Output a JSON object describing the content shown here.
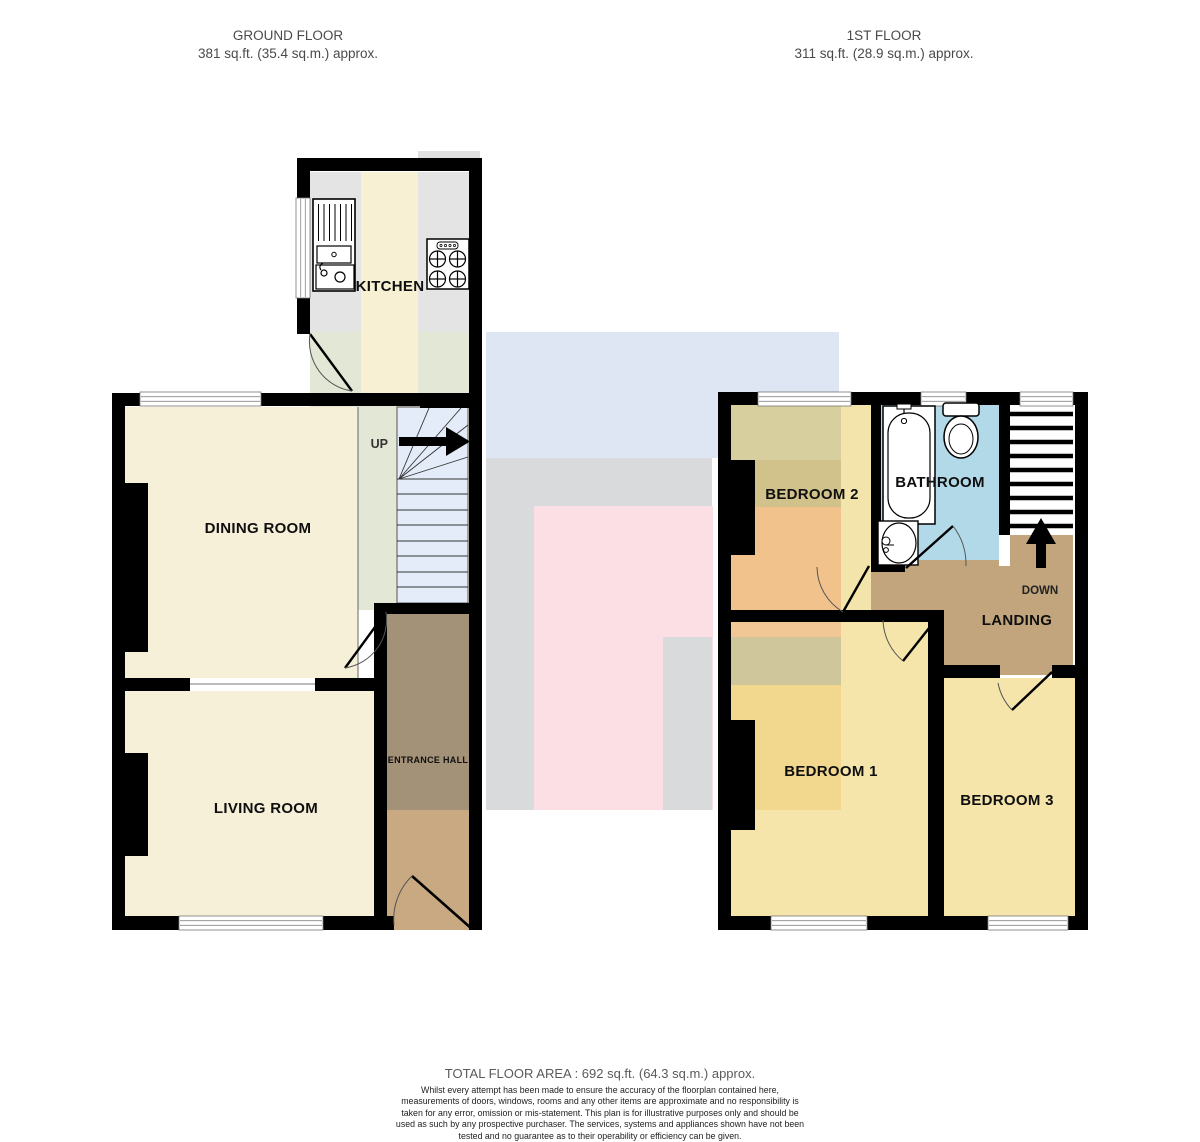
{
  "headers": {
    "ground_floor": {
      "title": "GROUND FLOOR",
      "area": "381 sq.ft. (35.4 sq.m.) approx."
    },
    "first_floor": {
      "title": "1ST FLOOR",
      "area": "311 sq.ft. (28.9 sq.m.) approx."
    }
  },
  "rooms": {
    "kitchen": "KITCHEN",
    "dining_room": "DINING ROOM",
    "living_room": "LIVING ROOM",
    "entrance_hall": "ENTRANCE HALL",
    "bedroom2": "BEDROOM 2",
    "bathroom": "BATHROOM",
    "landing": "LANDING",
    "bedroom1": "BEDROOM 1",
    "bedroom3": "BEDROOM 3"
  },
  "stairs": {
    "up_label": "UP",
    "down_label": "DOWN"
  },
  "footer": {
    "total": "TOTAL FLOOR AREA : 692 sq.ft. (64.3 sq.m.) approx.",
    "disclaimer": "Whilst every attempt has been made to ensure the accuracy of the floorplan contained here, measurements of doors, windows, rooms and any other items are approximate and no responsibility is taken for any error, omission or mis-statement. This plan is for illustrative purposes only and should be used as such by any prospective purchaser. The services, systems and appliances shown have not been tested and no guarantee as to their operability or efficiency can be given.",
    "credit": "Made with Metropix ©2025"
  },
  "palette": {
    "wall": "#000000",
    "cream": "#f6f0d8",
    "sage": "#e3e7d6",
    "stairs_blue": "#e3ecf8",
    "kitchen_gray": "#e4e4e4",
    "kitchen_cream": "#f8f0d2",
    "hall_dark": "#a39178",
    "hall_light": "#c9a981",
    "b2_olive": "#d8cf9e",
    "b2_khaki": "#d1c28c",
    "b2_orange": "#f1c28b",
    "b2_pale": "#f3e4ac",
    "bath_blue": "#b2d9e8",
    "landing_tan": "#c2a57d",
    "bed_base": "#f5e5ab",
    "bed1_orange": "#f0c795",
    "bed1_olive": "#cfc69b",
    "bed1_yellow": "#f2d88f",
    "overlay_blue": "#dde6f2",
    "overlay_gray": "#d9dadb",
    "overlay_pink": "#fbdfe4",
    "notch_gray": "#e0e0e0"
  }
}
